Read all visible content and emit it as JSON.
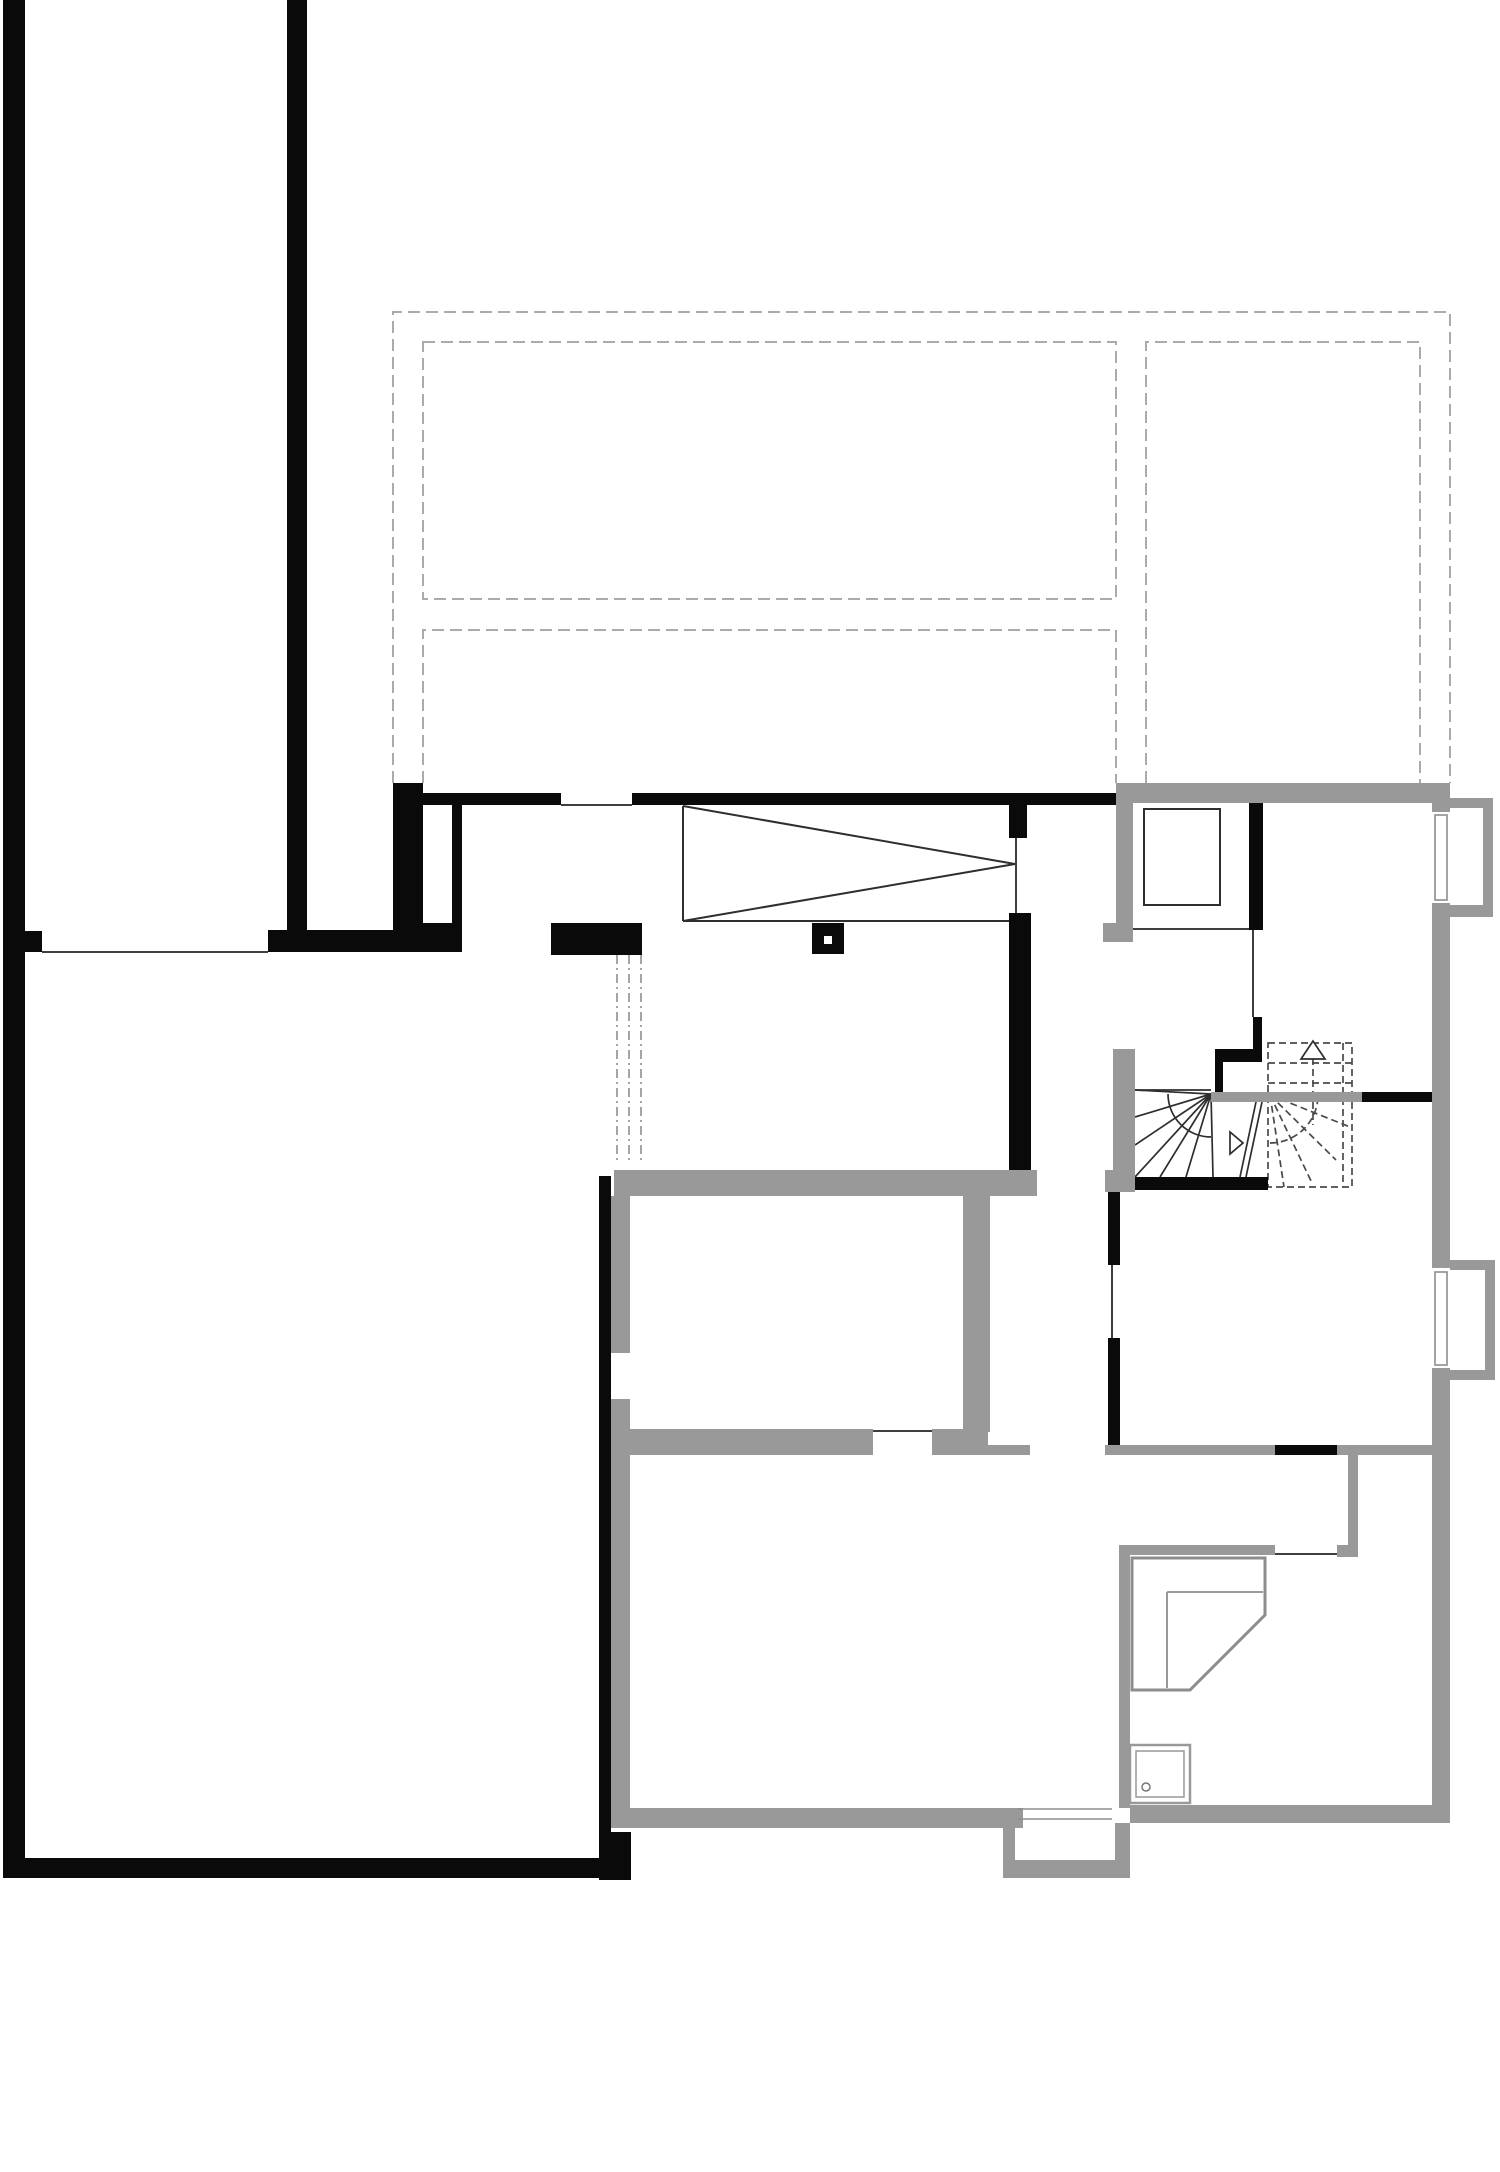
{
  "canvas": {
    "width": 1500,
    "height": 2172,
    "background": "#ffffff"
  },
  "palette": {
    "existing_wall": "#0a0a0a",
    "new_wall": "#999999",
    "opening_line": "#3f3f3f",
    "overhead_dash": "#ababab",
    "dashdot": "#9b9b9b",
    "fixture": "#8d8d8d",
    "stair_solid": "#2e2e2e",
    "stair_dash": "#4a4a4a",
    "white": "#ffffff"
  },
  "overhead_outline": {
    "stroke": "#ababab",
    "width": 2,
    "dash": "12 6",
    "shapes": [
      {
        "type": "polyline",
        "name": "roof-outline-outer",
        "points": "393,783 393,312 1450,312 1450,783"
      },
      {
        "type": "rect",
        "name": "roof-panel-top-left",
        "x": 423,
        "y": 342,
        "w": 693,
        "h": 257
      },
      {
        "type": "polyline",
        "name": "roof-panel-bottom-left",
        "points": "423,783 423,630 1116,630 1116,783"
      },
      {
        "type": "polyline",
        "name": "roof-panel-right",
        "points": "1146,783 1146,342 1420,342 1420,783"
      }
    ]
  },
  "dashdot_marks": {
    "stroke": "#9b9b9b",
    "width": 1.8,
    "dash": "9 4 2 4",
    "shapes": [
      {
        "type": "line",
        "name": "beam-mark-1",
        "x1": 617,
        "y1": 955,
        "x2": 617,
        "y2": 1162
      },
      {
        "type": "line",
        "name": "beam-mark-2",
        "x1": 629,
        "y1": 955,
        "x2": 629,
        "y2": 1162
      },
      {
        "type": "line",
        "name": "beam-mark-3",
        "x1": 641,
        "y1": 955,
        "x2": 641,
        "y2": 1162
      }
    ]
  },
  "opening_lines": {
    "stroke": "#3f3f3f",
    "width": 2,
    "shapes": [
      {
        "type": "line",
        "name": "opening-left-room-top",
        "x1": 42,
        "y1": 952,
        "x2": 268,
        "y2": 952
      },
      {
        "type": "line",
        "name": "window-sill-hall",
        "x1": 561,
        "y1": 805,
        "x2": 632,
        "y2": 805
      },
      {
        "type": "line",
        "name": "opening-hall-right",
        "x1": 1016,
        "y1": 838,
        "x2": 1016,
        "y2": 913
      },
      {
        "type": "line",
        "name": "opening-top-right-room",
        "x1": 1133,
        "y1": 929,
        "x2": 1250,
        "y2": 929
      },
      {
        "type": "line",
        "name": "opening-stair-top",
        "x1": 1253,
        "y1": 930,
        "x2": 1253,
        "y2": 1017
      },
      {
        "type": "line",
        "name": "door-right-room",
        "x1": 1112,
        "y1": 1265,
        "x2": 1112,
        "y2": 1338
      },
      {
        "type": "line",
        "name": "door-middle-room",
        "x1": 873,
        "y1": 1431,
        "x2": 932,
        "y2": 1431
      },
      {
        "type": "line",
        "name": "door-bath-room",
        "x1": 1275,
        "y1": 1554,
        "x2": 1337,
        "y2": 1554
      }
    ]
  },
  "skylight_wedge": {
    "stroke": "#2e2e2e",
    "width": 2,
    "shapes": [
      {
        "type": "line",
        "name": "wedge-left-edge",
        "x1": 683,
        "y1": 806,
        "x2": 683,
        "y2": 921
      },
      {
        "type": "line",
        "name": "wedge-top-diagonal",
        "x1": 683,
        "y1": 806,
        "x2": 1015,
        "y2": 864
      },
      {
        "type": "line",
        "name": "wedge-bottom-diagonal",
        "x1": 683,
        "y1": 921,
        "x2": 1015,
        "y2": 864
      },
      {
        "type": "line",
        "name": "wedge-base",
        "x1": 683,
        "y1": 921,
        "x2": 1013,
        "y2": 921
      }
    ]
  },
  "stair_solid": {
    "stroke": "#2e2e2e",
    "width": 1.7,
    "shapes": [
      {
        "type": "line",
        "name": "stair-tread-line",
        "x1": 1135,
        "y1": 1090,
        "x2": 1211,
        "y2": 1090
      },
      {
        "type": "line",
        "name": "stair-fan-1",
        "x1": 1211,
        "y1": 1094,
        "x2": 1135,
        "y2": 1090
      },
      {
        "type": "line",
        "name": "stair-fan-2",
        "x1": 1211,
        "y1": 1094,
        "x2": 1135,
        "y2": 1117
      },
      {
        "type": "line",
        "name": "stair-fan-3",
        "x1": 1211,
        "y1": 1094,
        "x2": 1135,
        "y2": 1145
      },
      {
        "type": "line",
        "name": "stair-fan-4",
        "x1": 1211,
        "y1": 1094,
        "x2": 1135,
        "y2": 1177
      },
      {
        "type": "line",
        "name": "stair-fan-5",
        "x1": 1211,
        "y1": 1094,
        "x2": 1160,
        "y2": 1177
      },
      {
        "type": "line",
        "name": "stair-fan-6",
        "x1": 1211,
        "y1": 1094,
        "x2": 1186,
        "y2": 1177
      },
      {
        "type": "line",
        "name": "stair-fan-7",
        "x1": 1211,
        "y1": 1094,
        "x2": 1213,
        "y2": 1177
      },
      {
        "type": "path",
        "name": "stair-arc",
        "d": "M 1168,1094 A 43 43 0 0 0 1211,1137"
      },
      {
        "type": "line",
        "name": "stair-walkline-1",
        "x1": 1240,
        "y1": 1177,
        "x2": 1256,
        "y2": 1102
      },
      {
        "type": "line",
        "name": "stair-walkline-2",
        "x1": 1246,
        "y1": 1177,
        "x2": 1262,
        "y2": 1102
      },
      {
        "type": "polygon",
        "name": "stair-walk-arrowhead",
        "points": "1230,1132 1230,1154 1243,1143",
        "fill": "#ffffff"
      }
    ]
  },
  "stair_dashed": {
    "stroke": "#4a4a4a",
    "width": 1.7,
    "dash": "7 4",
    "shapes": [
      {
        "type": "rect",
        "name": "stair-upper-flight-outline",
        "x": 1268,
        "y": 1043,
        "w": 84,
        "h": 144
      },
      {
        "type": "line",
        "name": "stair-upper-tread-1",
        "x1": 1268,
        "y1": 1063,
        "x2": 1352,
        "y2": 1063
      },
      {
        "type": "line",
        "name": "stair-upper-tread-2",
        "x1": 1268,
        "y1": 1083,
        "x2": 1352,
        "y2": 1083
      },
      {
        "type": "line",
        "name": "stair-upper-stringer",
        "x1": 1343,
        "y1": 1043,
        "x2": 1343,
        "y2": 1187
      },
      {
        "type": "line",
        "name": "stair-upper-fan-1",
        "x1": 1270,
        "y1": 1095,
        "x2": 1284,
        "y2": 1187
      },
      {
        "type": "line",
        "name": "stair-upper-fan-2",
        "x1": 1270,
        "y1": 1095,
        "x2": 1312,
        "y2": 1183
      },
      {
        "type": "line",
        "name": "stair-upper-fan-3",
        "x1": 1270,
        "y1": 1095,
        "x2": 1336,
        "y2": 1160
      },
      {
        "type": "line",
        "name": "stair-upper-fan-4",
        "x1": 1270,
        "y1": 1095,
        "x2": 1350,
        "y2": 1127
      },
      {
        "type": "path",
        "name": "stair-upper-arc",
        "d": "M 1270,1143 A 48 48 0 0 0 1318,1095"
      },
      {
        "type": "line",
        "name": "stair-up-arrow-stem",
        "x1": 1313,
        "y1": 1058,
        "x2": 1313,
        "y2": 1125
      }
    ]
  },
  "stair_arrow": {
    "stroke": "#2e2e2e",
    "width": 1.7,
    "shapes": [
      {
        "type": "polygon",
        "name": "stair-up-arrowhead",
        "points": "1313,1041 1301,1059 1325,1059",
        "fill": "#ffffff"
      }
    ]
  },
  "new_walls": {
    "fill": "#999999",
    "shapes": [
      {
        "type": "wrect",
        "name": "wall-top-right",
        "x": 1116,
        "y": 783,
        "w": 334,
        "h": 20
      },
      {
        "type": "wrect",
        "name": "wall-shaft-left",
        "x": 1116,
        "y": 803,
        "w": 17,
        "h": 120
      },
      {
        "type": "wrect",
        "name": "wall-shaft-foot",
        "x": 1103,
        "y": 923,
        "w": 30,
        "h": 19
      },
      {
        "type": "wrect",
        "name": "wall-right-outer-a",
        "x": 1432,
        "y": 803,
        "w": 18,
        "h": 9
      },
      {
        "type": "wrect",
        "name": "wall-right-outer-b",
        "x": 1432,
        "y": 903,
        "w": 18,
        "h": 365
      },
      {
        "type": "wrect",
        "name": "wall-right-outer-c",
        "x": 1432,
        "y": 1368,
        "w": 18,
        "h": 455
      },
      {
        "type": "wrect",
        "name": "bay1-top",
        "x": 1450,
        "y": 798,
        "w": 43,
        "h": 10
      },
      {
        "type": "wrect",
        "name": "bay1-right",
        "x": 1483,
        "y": 798,
        "w": 10,
        "h": 119
      },
      {
        "type": "wrect",
        "name": "bay1-bottom",
        "x": 1450,
        "y": 905,
        "w": 43,
        "h": 12
      },
      {
        "type": "wrect",
        "name": "bay2-top",
        "x": 1450,
        "y": 1260,
        "w": 45,
        "h": 10
      },
      {
        "type": "wrect",
        "name": "bay2-right",
        "x": 1485,
        "y": 1260,
        "w": 10,
        "h": 120
      },
      {
        "type": "wrect",
        "name": "bay2-bottom",
        "x": 1450,
        "y": 1370,
        "w": 45,
        "h": 10
      },
      {
        "type": "wrect",
        "name": "wall-stair-left",
        "x": 1113,
        "y": 1049,
        "w": 22,
        "h": 143
      },
      {
        "type": "wrect",
        "name": "wall-stair-left-foot",
        "x": 1105,
        "y": 1170,
        "w": 30,
        "h": 22
      },
      {
        "type": "wrect",
        "name": "wall-stair-top-gray",
        "x": 1211,
        "y": 1092,
        "w": 151,
        "h": 10
      },
      {
        "type": "wrect",
        "name": "wall-room-a-top",
        "x": 614,
        "y": 1170,
        "w": 423,
        "h": 26
      },
      {
        "type": "wrect",
        "name": "lining-left-upper",
        "x": 611,
        "y": 1196,
        "w": 19,
        "h": 157
      },
      {
        "type": "wrect",
        "name": "lining-left-lower",
        "x": 611,
        "y": 1399,
        "w": 19,
        "h": 409
      },
      {
        "type": "wrect",
        "name": "wall-room-a-right",
        "x": 963,
        "y": 1196,
        "w": 27,
        "h": 236
      },
      {
        "type": "wrect",
        "name": "wall-room-a-bottom",
        "x": 611,
        "y": 1429,
        "w": 262,
        "h": 26
      },
      {
        "type": "wrect",
        "name": "wall-door-pier",
        "x": 932,
        "y": 1429,
        "w": 56,
        "h": 26
      },
      {
        "type": "wrect",
        "name": "wall-corridor-a",
        "x": 988,
        "y": 1445,
        "w": 42,
        "h": 10
      },
      {
        "type": "wrect",
        "name": "wall-corridor-b",
        "x": 1105,
        "y": 1445,
        "w": 170,
        "h": 10
      },
      {
        "type": "wrect",
        "name": "wall-corridor-c",
        "x": 1337,
        "y": 1445,
        "w": 95,
        "h": 10
      },
      {
        "type": "wrect",
        "name": "wall-corridor-right",
        "x": 1348,
        "y": 1455,
        "w": 10,
        "h": 92
      },
      {
        "type": "wrect",
        "name": "wall-bath-top",
        "x": 1119,
        "y": 1545,
        "w": 156,
        "h": 10
      },
      {
        "type": "wrect",
        "name": "wall-bath-corner",
        "x": 1337,
        "y": 1545,
        "w": 21,
        "h": 12
      },
      {
        "type": "wrect",
        "name": "wall-bath-left",
        "x": 1119,
        "y": 1555,
        "w": 11,
        "h": 253
      },
      {
        "type": "wrect",
        "name": "wall-bath-bottom",
        "x": 1130,
        "y": 1805,
        "w": 320,
        "h": 18
      },
      {
        "type": "wrect",
        "name": "wall-middle-bottom",
        "x": 611,
        "y": 1808,
        "w": 412,
        "h": 20
      },
      {
        "type": "wrect",
        "name": "vestibule-left",
        "x": 1003,
        "y": 1828,
        "w": 12,
        "h": 50
      },
      {
        "type": "wrect",
        "name": "vestibule-bottom",
        "x": 1015,
        "y": 1860,
        "w": 115,
        "h": 18
      },
      {
        "type": "wrect",
        "name": "vestibule-right",
        "x": 1115,
        "y": 1823,
        "w": 15,
        "h": 37
      }
    ]
  },
  "existing_walls": {
    "fill": "#0a0a0a",
    "shapes": [
      {
        "type": "wrect",
        "name": "wall-left-outer",
        "x": 3,
        "y": 0,
        "w": 22,
        "h": 1878
      },
      {
        "type": "wrect",
        "name": "wall-left-tab",
        "x": 25,
        "y": 931,
        "w": 17,
        "h": 21
      },
      {
        "type": "wrect",
        "name": "wall-court-right",
        "x": 287,
        "y": 0,
        "w": 20,
        "h": 930
      },
      {
        "type": "wrect",
        "name": "wall-court-bottom",
        "x": 268,
        "y": 930,
        "w": 194,
        "h": 22
      },
      {
        "type": "wrect",
        "name": "wall-pier-a",
        "x": 393,
        "y": 783,
        "w": 30,
        "h": 169
      },
      {
        "type": "wrect",
        "name": "wall-pier-b",
        "x": 452,
        "y": 805,
        "w": 10,
        "h": 118
      },
      {
        "type": "wrect",
        "name": "wall-pier-fill",
        "x": 423,
        "y": 923,
        "w": 39,
        "h": 29
      },
      {
        "type": "wrect",
        "name": "wall-hall-top-left",
        "x": 423,
        "y": 793,
        "w": 138,
        "h": 12
      },
      {
        "type": "wrect",
        "name": "wall-hall-top-main",
        "x": 632,
        "y": 793,
        "w": 484,
        "h": 12
      },
      {
        "type": "wrect",
        "name": "wall-block-left-room",
        "x": 551,
        "y": 923,
        "w": 91,
        "h": 32
      },
      {
        "type": "wrect",
        "name": "column",
        "x": 812,
        "y": 923,
        "w": 32,
        "h": 31
      },
      {
        "type": "wrect",
        "name": "wall-hall-right-stub",
        "x": 1009,
        "y": 803,
        "w": 18,
        "h": 35
      },
      {
        "type": "wrect",
        "name": "wall-hall-right-main",
        "x": 1009,
        "y": 913,
        "w": 22,
        "h": 257
      },
      {
        "type": "wrect",
        "name": "wall-stair-entry",
        "x": 1249,
        "y": 803,
        "w": 14,
        "h": 127
      },
      {
        "type": "wrect",
        "name": "stair-zig-a",
        "x": 1253,
        "y": 1017,
        "w": 9,
        "h": 41
      },
      {
        "type": "wrect",
        "name": "stair-zig-b",
        "x": 1215,
        "y": 1049,
        "w": 47,
        "h": 13
      },
      {
        "type": "wrect",
        "name": "stair-zig-c",
        "x": 1215,
        "y": 1062,
        "w": 8,
        "h": 30
      },
      {
        "type": "wrect",
        "name": "wall-stair-top-black",
        "x": 1362,
        "y": 1092,
        "w": 70,
        "h": 10
      },
      {
        "type": "wrect",
        "name": "wall-stair-bottom",
        "x": 1135,
        "y": 1177,
        "w": 133,
        "h": 13
      },
      {
        "type": "wrect",
        "name": "wall-right-room-left-a",
        "x": 1108,
        "y": 1192,
        "w": 12,
        "h": 73
      },
      {
        "type": "wrect",
        "name": "wall-right-room-left-b",
        "x": 1108,
        "y": 1338,
        "w": 12,
        "h": 107
      },
      {
        "type": "wrect",
        "name": "wall-corridor-black-seg",
        "x": 1275,
        "y": 1445,
        "w": 62,
        "h": 10
      },
      {
        "type": "wrect",
        "name": "wall-middle-left",
        "x": 599,
        "y": 1176,
        "w": 12,
        "h": 656
      },
      {
        "type": "wrect",
        "name": "wall-bottom-corner-block",
        "x": 599,
        "y": 1832,
        "w": 32,
        "h": 48
      },
      {
        "type": "wrect",
        "name": "wall-bottom-outer",
        "x": 3,
        "y": 1858,
        "w": 596,
        "h": 20
      }
    ]
  },
  "white_overlays": {
    "fill": "#ffffff",
    "shapes": [
      {
        "type": "wrect",
        "name": "niche-cutout",
        "x": 423,
        "y": 805,
        "w": 29,
        "h": 118
      },
      {
        "type": "wrect",
        "name": "column-core-hole",
        "x": 824,
        "y": 936,
        "w": 8,
        "h": 8
      }
    ]
  },
  "fixtures": {
    "shapes": [
      {
        "type": "rect",
        "name": "shaft-box",
        "x": 1144,
        "y": 809,
        "w": 76,
        "h": 96,
        "stroke": "#2e2e2e",
        "width": 2
      },
      {
        "type": "wrect",
        "name": "window1-opening",
        "x": 1432,
        "y": 812,
        "w": 18,
        "h": 91,
        "fill": "#ffffff"
      },
      {
        "type": "rect",
        "name": "window1-frame",
        "x": 1435,
        "y": 815,
        "w": 12,
        "h": 85,
        "stroke": "#8d8d8d",
        "width": 1.6
      },
      {
        "type": "wrect",
        "name": "window2-opening",
        "x": 1432,
        "y": 1268,
        "w": 18,
        "h": 100,
        "fill": "#ffffff"
      },
      {
        "type": "rect",
        "name": "window2-frame",
        "x": 1435,
        "y": 1272,
        "w": 12,
        "h": 93,
        "stroke": "#8d8d8d",
        "width": 1.6
      },
      {
        "type": "polygon",
        "name": "corner-counter",
        "points": "1132,1558 1265,1558 1265,1615 1190,1690 1132,1690",
        "stroke": "#8d8d8d",
        "width": 3,
        "fill": "none"
      },
      {
        "type": "line",
        "name": "corner-counter-inner-h",
        "x1": 1167,
        "y1": 1592,
        "x2": 1263,
        "y2": 1592,
        "stroke": "#8d8d8d",
        "width": 1.8
      },
      {
        "type": "line",
        "name": "corner-counter-inner-v",
        "x1": 1167,
        "y1": 1592,
        "x2": 1167,
        "y2": 1688,
        "stroke": "#8d8d8d",
        "width": 1.8
      },
      {
        "type": "rect",
        "name": "shower-tray-outer",
        "x": 1130,
        "y": 1745,
        "w": 60,
        "h": 58,
        "stroke": "#999999",
        "width": 2.5
      },
      {
        "type": "rect",
        "name": "shower-tray-inner",
        "x": 1136,
        "y": 1751,
        "w": 48,
        "h": 46,
        "stroke": "#999999",
        "width": 1.5
      },
      {
        "type": "circle",
        "name": "shower-drain",
        "cx": 1146,
        "cy": 1787,
        "r": 4,
        "stroke": "#777777",
        "width": 1.5
      },
      {
        "type": "line",
        "name": "threshold-line-1",
        "x1": 1018,
        "y1": 1809,
        "x2": 1112,
        "y2": 1809,
        "stroke": "#8d8d8d",
        "width": 1.5
      },
      {
        "type": "line",
        "name": "threshold-line-2",
        "x1": 1018,
        "y1": 1819,
        "x2": 1112,
        "y2": 1819,
        "stroke": "#8d8d8d",
        "width": 1.5
      }
    ]
  }
}
